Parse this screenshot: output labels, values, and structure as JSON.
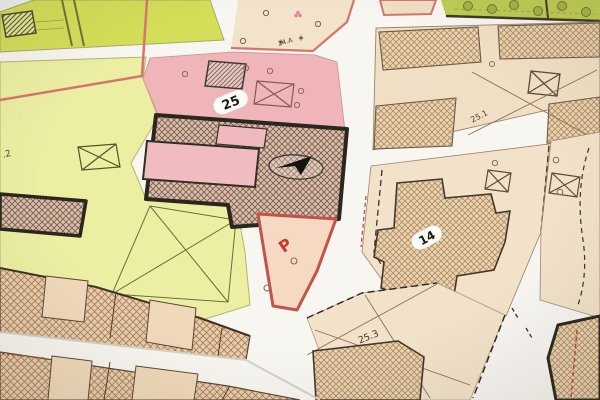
{
  "map": {
    "labels": {
      "block_25": "25",
      "block_14": "14",
      "parcel_25_1": "25.1",
      "parcel_25_3": "25.3",
      "parcel_24_a": "24.A",
      "parking": "P",
      "edge_partial": ".2"
    },
    "colors": {
      "chartreuse_bright": "#d5de58",
      "chartreuse_pale": "#ecefa2",
      "pink_zone": "#f0b5b9",
      "pink_strip": "#eeb2b6",
      "beige_parcel": "#f1dfc5",
      "beige_parcel_2": "#f2e2ca",
      "beige_24a": "#f4e3cb",
      "peach_parking": "#f5d9c2",
      "red_border": "#c4524a",
      "pink_border": "#d4766e",
      "dark_outline": "#2c2620",
      "garden_green": "#bfcc54",
      "street_white": "#f8f6f1",
      "paper_edge": "#f0f1ef"
    }
  }
}
